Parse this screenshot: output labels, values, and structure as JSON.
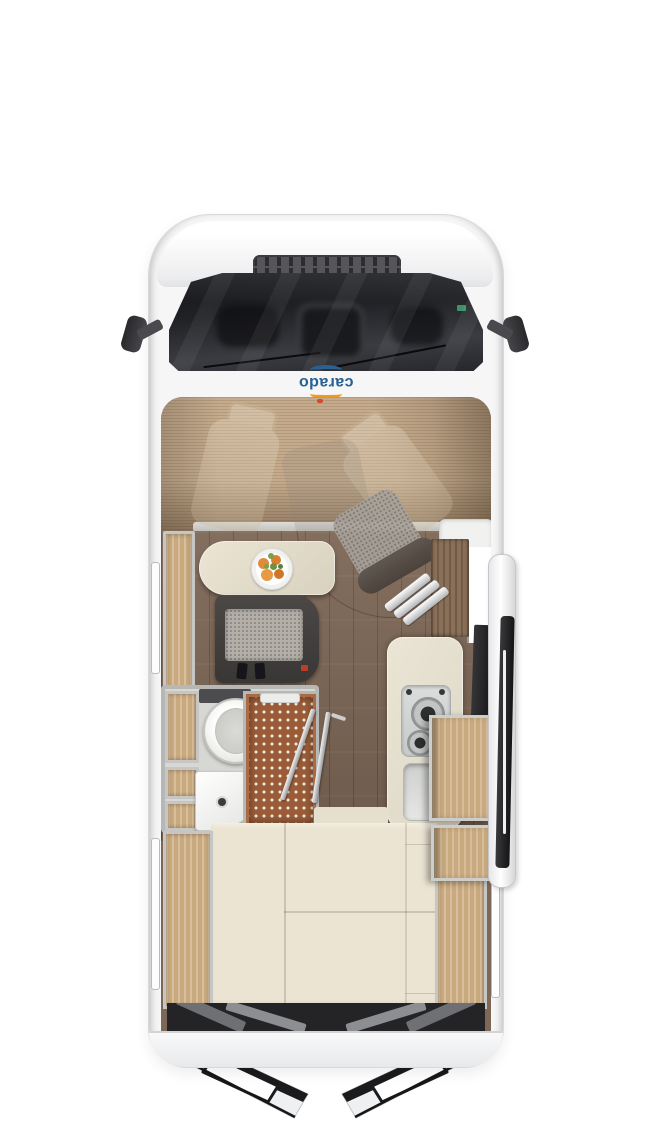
{
  "logo": {
    "text": "carado"
  },
  "colors": {
    "scene-bg": "#ffffff",
    "body-shell": "#f6f6f7",
    "body-edge": "#d8d9db",
    "windshield-dark": "#1d1e21",
    "cab-wood": "#c4ab8d",
    "floor-wood": "#7d6756",
    "oak-light": "#c9a97e",
    "wood-dark": "#8a7058",
    "cream-table": "#e6dfcd",
    "cream-bed": "#ece4d2",
    "bench-dark": "#44413f",
    "cushion-gray": "#b4b0a9",
    "shower-brown": "#9a5c38",
    "counter-cream": "#e8e2d3",
    "hob-gray": "#d3d6d5",
    "wall-gray": "#b7b8b6",
    "door-dark": "#1b1b1d",
    "accent-red": "#c23b2a",
    "logo-blue": "#2a6193",
    "logo-orange": "#f39a1e"
  }
}
